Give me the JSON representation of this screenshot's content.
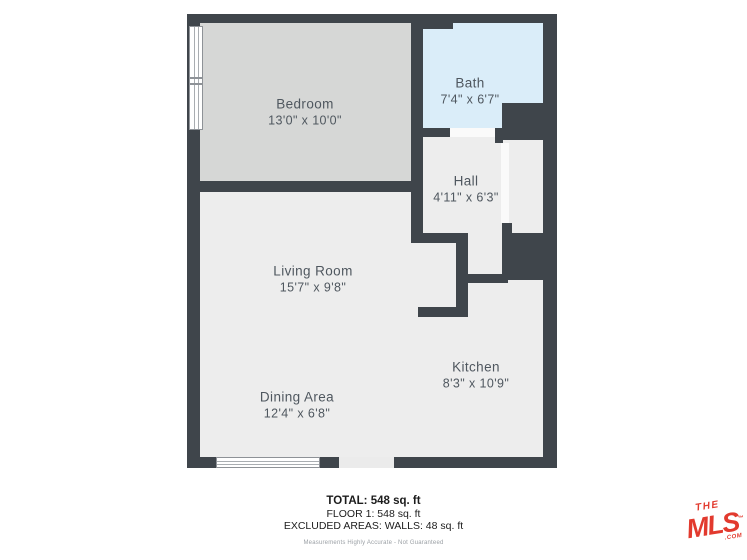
{
  "rooms": {
    "bedroom": {
      "name": "Bedroom",
      "dims": "13'0\" x 10'0\""
    },
    "bath": {
      "name": "Bath",
      "dims": "7'4\" x 6'7\""
    },
    "hall": {
      "name": "Hall",
      "dims": "4'11\" x 6'3\""
    },
    "living": {
      "name": "Living Room",
      "dims": "15'7\" x 9'8\""
    },
    "dining": {
      "name": "Dining Area",
      "dims": "12'4\" x 6'8\""
    },
    "kitchen": {
      "name": "Kitchen",
      "dims": "8'3\" x 10'9\""
    }
  },
  "summary": {
    "total": "TOTAL: 548 sq. ft",
    "floor": "FLOOR 1: 548 sq. ft",
    "excluded": "EXCLUDED AREAS: WALLS: 48 sq. ft",
    "disclaimer": "Measurements Highly Accurate - Not Guaranteed"
  },
  "logo": {
    "the": "THE",
    "mls": "MLS",
    "tm": "™",
    "com": ".COM"
  },
  "colors": {
    "wall": "#3F454B",
    "floor": "#EDEDED",
    "bedroom_fill": "#D6D7D6",
    "bath_fill": "#DAEDF9",
    "label_text": "#4F575F",
    "logo_red": "#E23A2E"
  }
}
